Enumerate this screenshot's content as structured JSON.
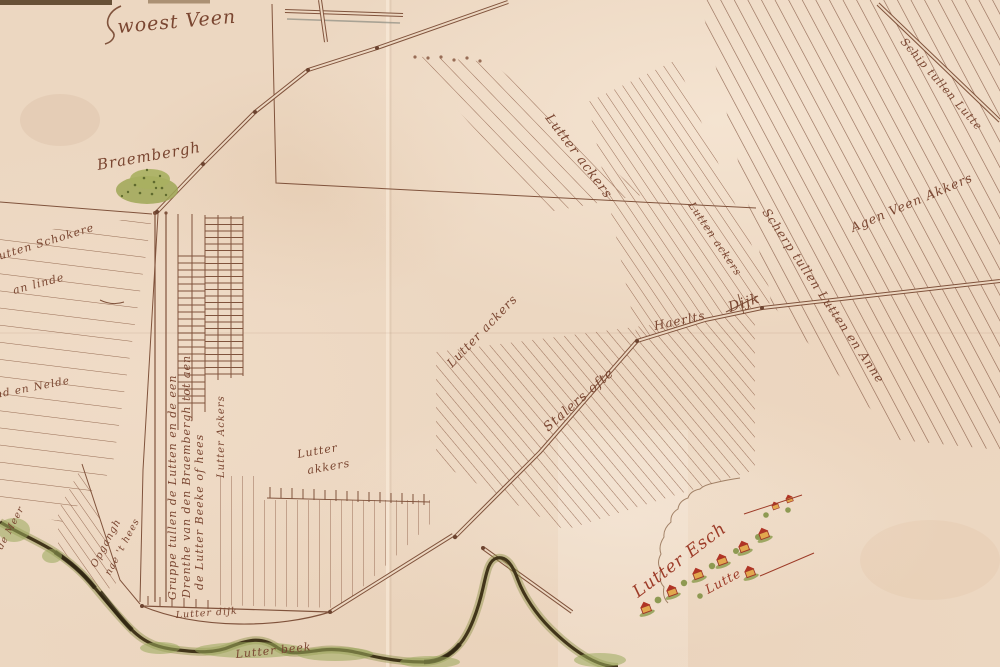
{
  "map": {
    "type": "historical-manuscript-estate-map",
    "labels": {
      "woest_veen": "woest Veen",
      "braembergh": "Braembergh",
      "lutter_ackers_top": "Lutter ackers",
      "lutten_ackers_mid": "Lutten ackers",
      "scherp_boundary": "Scherp tullen Lutten en Anne",
      "agen_veen_akkers": "Agen Veen Akkers",
      "schip_road": "Schip tullen Lutte",
      "stalers": "Stalers ofte",
      "haerlts": "Haerlts",
      "dijk": "Dijk",
      "lutter_ackers_mid2": "Lutter ackers",
      "lutter_small_1": "Lutter",
      "lutter_small_2": "akkers",
      "lutten_schokere_1": "Lutten Schokere",
      "lutten_schokere_2": "an linde",
      "nd_en_nelde": "nd en Nelde",
      "gruppe_line_1": "Gruppe tullen de Lutten en de een",
      "gruppe_line_2": "Drenthe van den Braembergh tot aen",
      "gruppe_line_3": "de Lutter Beeke of hees",
      "lutter_ackers_vertical": "Lutter Ackers",
      "opgangh_1": "Opgangh",
      "opgangh_2": "nae 't hees",
      "de_meer": "de Meer",
      "lutter_dijk": "Lutter dijk",
      "lutter_beek": "Lutter beek",
      "lutter_esch": "Lutter Esch",
      "lutte": "Lutte"
    },
    "colors": {
      "paper": "#ecd7c1",
      "ink_lines": "#80533c",
      "ink_text": "#7a4631",
      "red_text": "#9d3b28",
      "vegetation_green": "#9fa756",
      "stream_dark": "#42351a",
      "house_red": "#b03425",
      "house_yellow": "#e2a84e"
    }
  }
}
